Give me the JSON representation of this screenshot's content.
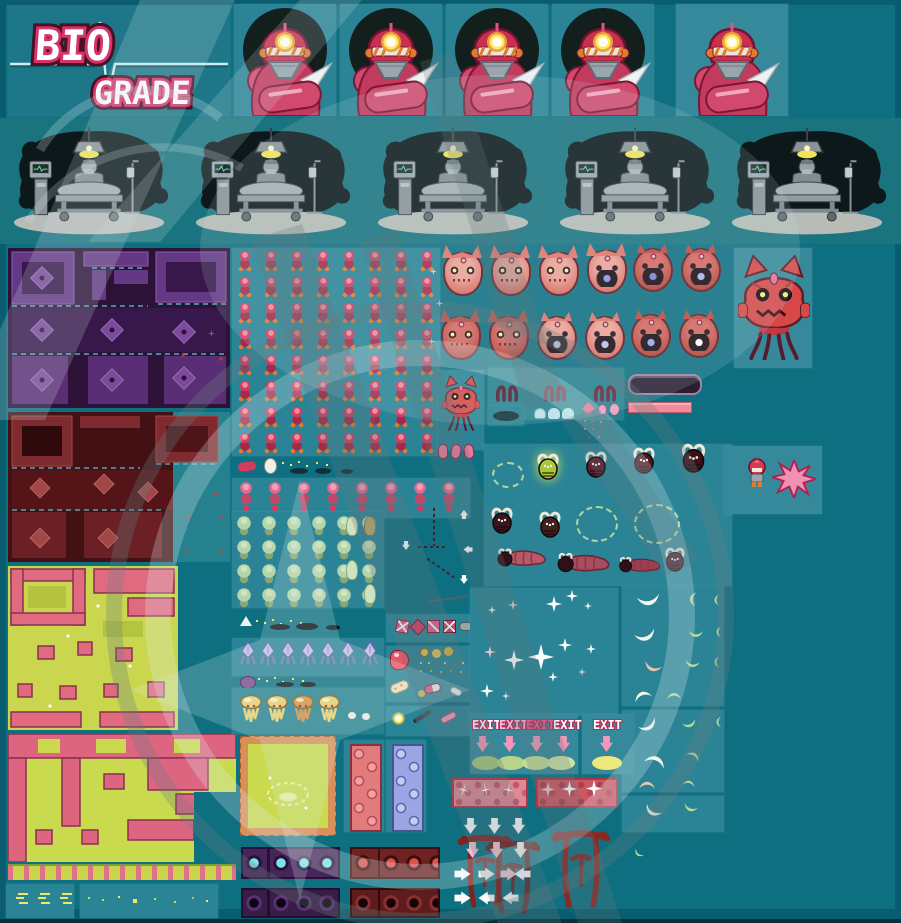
{
  "title": "BIO GRADE sprite sheet",
  "logo": {
    "line1": "BIO",
    "line2": "GRADE"
  },
  "exit_signs": {
    "labels": [
      "EXIT",
      "EXIT",
      "EXIT",
      "EXIT"
    ],
    "single": "EXIT"
  },
  "palette": {
    "background": "#0e6f80",
    "border": "#0a5d6e",
    "panel": "#2b8496",
    "logo_pink": "#d63a6e",
    "logo_outline": "#4a1025",
    "ekg_line": "#c6eef4",
    "hero_red": "#d23c60",
    "enemy_red": "#e2756a",
    "enemy_dark_red": "#c04840",
    "accent_orange": "#e07b2f",
    "map_purple": "#643884",
    "map_maroon": "#7e2a2e",
    "map_yellow_green": "#c9d64e",
    "map_pink": "#e06a80",
    "effect_white": "#f2f6ec",
    "arrow_pink": "#f297b8"
  },
  "sections": {
    "logo_panel": "Bio Grade logo with EKG heartbeat line",
    "portraits": {
      "label": "medic character portrait",
      "count": 5
    },
    "operating_scenes": {
      "label": "operating room scene",
      "count": 5
    },
    "tilemaps": [
      "purple dungeon map",
      "maroon dungeon map",
      "yellow-green overworld map",
      "pink flesh map"
    ],
    "hero_walk_grid": {
      "columns": 8,
      "rows": 8
    },
    "pink_walk_row": {
      "count": 8
    },
    "enemy_faces": {
      "rows": 2,
      "per_row": 6
    },
    "boss": "red jellyfish boss creature",
    "effects": [
      "sparkles",
      "slash crescents",
      "dashed auras",
      "white arrows",
      "pink arrows",
      "torii gates"
    ],
    "items": [
      "health bar",
      "pink bar",
      "pills",
      "bandage",
      "coins",
      "flask",
      "syringe",
      "glow orb"
    ]
  }
}
